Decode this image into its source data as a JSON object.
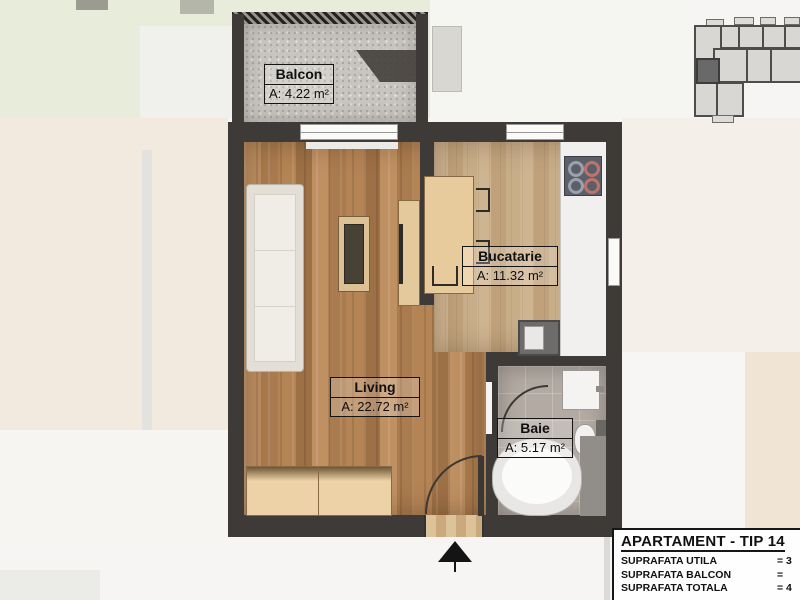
{
  "rooms": [
    {
      "id": "balcon",
      "name": "Balcon",
      "area": "A: 4.22 m²"
    },
    {
      "id": "bucatarie",
      "name": "Bucatarie",
      "area": "A: 11.32 m²"
    },
    {
      "id": "living",
      "name": "Living",
      "area": "A: 22.72 m²"
    },
    {
      "id": "baie",
      "name": "Baie",
      "area": "A: 5.17 m²"
    }
  ],
  "info_panel": {
    "title": "APARTAMENT - TIP 14",
    "rows": [
      {
        "label": "SUPRAFATA UTILA",
        "value": "= 3"
      },
      {
        "label": "SUPRAFATA BALCON",
        "value": "="
      },
      {
        "label": "SUPRAFATA TOTALA",
        "value": "= 4"
      }
    ]
  },
  "colors": {
    "wall": "#3e3a38",
    "living_wood": "#b5895c",
    "kitchen_wood": "#c8ab87",
    "bath_tile": "#b3aaa3",
    "balcony_concrete": "#c8c4bf",
    "furniture_tan": "#e8cb9c",
    "key_plan_highlight": "#696969"
  }
}
